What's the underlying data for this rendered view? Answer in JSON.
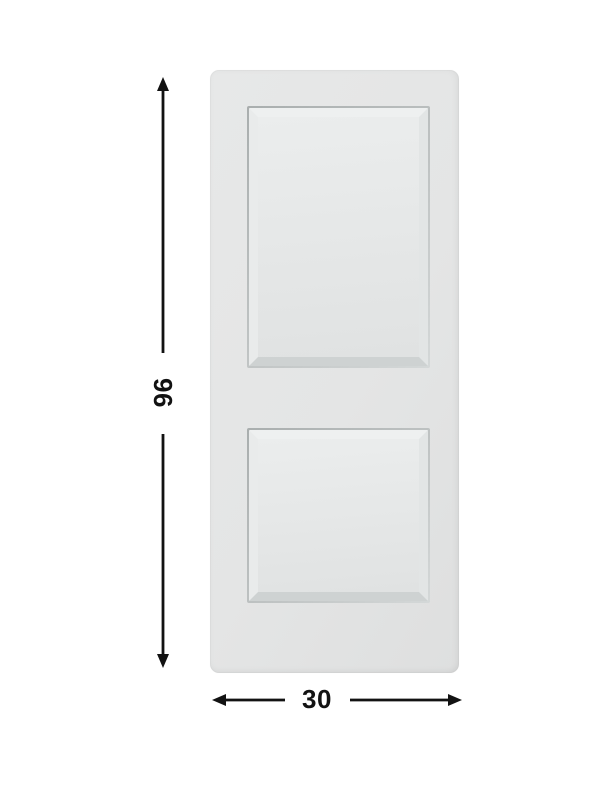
{
  "diagram": {
    "type": "product-dimension-diagram",
    "product": "two-panel door",
    "height_dimension": "96",
    "width_dimension": "30",
    "panel_count": 2
  },
  "colors": {
    "background": "#ffffff",
    "door_face": "#e4e5e5",
    "panel_groove": "#a9aeae",
    "panel_face": "#ebeded",
    "dimension_ink": "#121212"
  }
}
